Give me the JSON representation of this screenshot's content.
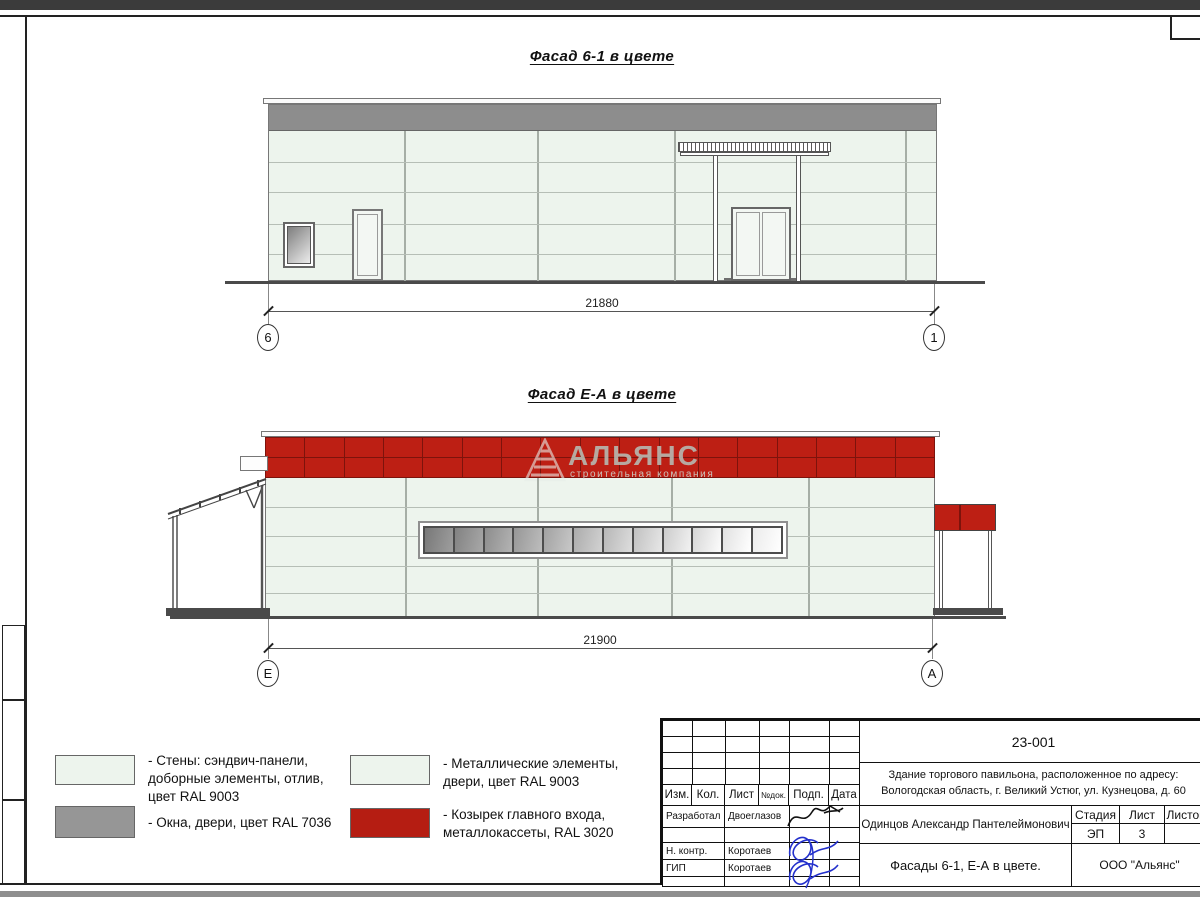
{
  "facade1": {
    "title": "Фасад 6-1 в цвете",
    "dimension": "21880",
    "axis_left": "6",
    "axis_right": "1"
  },
  "facade2": {
    "title": "Фасад Е-А в цвете",
    "dimension": "21900",
    "axis_left": "Е",
    "axis_right": "А",
    "watermark_name": "АЛЬЯНС",
    "watermark_subtitle": "строительная компания"
  },
  "legend": {
    "items": [
      {
        "swatch": "#edf4ed",
        "label": "- Стены: сэндвич-панели,\nдоборные элементы, отлив,\nцвет RAL 9003"
      },
      {
        "swatch": "#969696",
        "label": "- Окна, двери, цвет RAL 7036"
      },
      {
        "swatch": "#edf4ed",
        "label": "- Металлические элементы,\nдвери, цвет RAL 9003"
      },
      {
        "swatch": "#b51d12",
        "label": "- Козырек главного входа,\nметаллокассеты, RAL 3020"
      }
    ]
  },
  "titleblock": {
    "doc_number": "23-001",
    "project": "Здание торгового павильона, расположенное по адресу:\nВологодская область, г. Великий Устюг, ул. Кузнецова, д. 60",
    "cols": {
      "izm": "Изм.",
      "kol": "Кол.",
      "list": "Лист",
      "ndok": "№док.",
      "podp": "Подп.",
      "data": "Дата"
    },
    "rows": [
      {
        "role": "Разработал",
        "name": "Двоеглазов"
      },
      {
        "role": "Н. контр.",
        "name": "Коротаев"
      },
      {
        "role": "ГИП",
        "name": "Коротаев"
      }
    ],
    "author": "Одинцов Александр Пантелеймонович",
    "stage_label": "Стадия",
    "sheet_label": "Лист",
    "sheets_label": "Листов",
    "stage": "ЭП",
    "sheet": "3",
    "sheets": "",
    "sheet_title": "Фасады 6-1, Е-А в цвете.",
    "company": "ООО \"Альянс\""
  },
  "colors": {
    "red": "#bd1f14",
    "panel": "#edf4ed",
    "gray_band": "#8d8d8d",
    "signature_blue": "#2330cc"
  }
}
